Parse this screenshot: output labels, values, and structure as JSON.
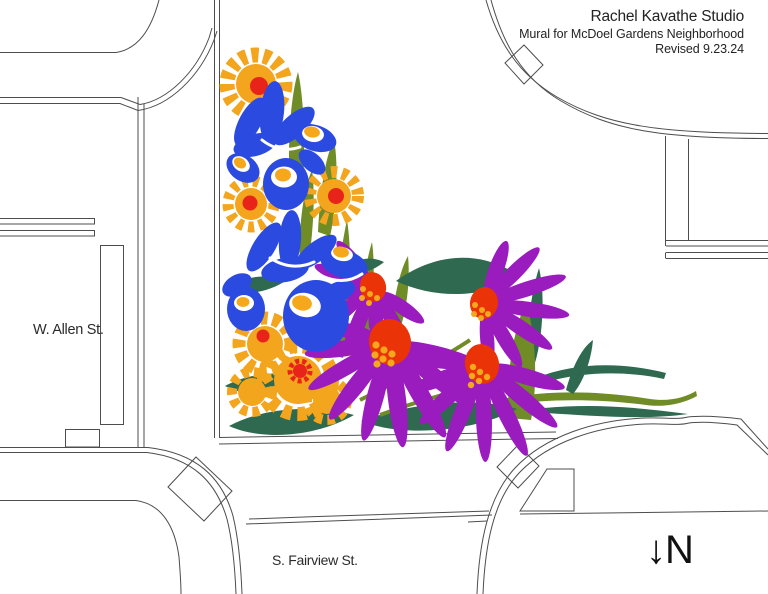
{
  "header": {
    "studio": "Rachel Kavathe Studio",
    "project": "Mural for McDoel Gardens Neighborhood",
    "revision": "Revised 9.23.24"
  },
  "map": {
    "streets": [
      {
        "label": "W. Allen St."
      },
      {
        "label": "S. Fairview St."
      }
    ],
    "north": {
      "arrow": "↓",
      "label": "N"
    }
  },
  "mural": {
    "palette": {
      "orange": "#F2A51D",
      "red": "#E8241A",
      "blue": "#2B4AE0",
      "olive": "#6F8C26",
      "pine": "#2F6A50",
      "purple": "#9A1CBE",
      "conered": "#EA3307",
      "dots": "#F6A81C",
      "line": "#4d4d4d",
      "ink": "#232323"
    },
    "flowers": [
      {
        "type": "coreopsis",
        "color": "orange-with-red-center",
        "count": 5
      },
      {
        "type": "iris",
        "color": "blue-with-white-and-orange",
        "count": 2
      },
      {
        "type": "coneflower",
        "color": "purple-with-red-orange-center",
        "count": 4
      }
    ]
  }
}
